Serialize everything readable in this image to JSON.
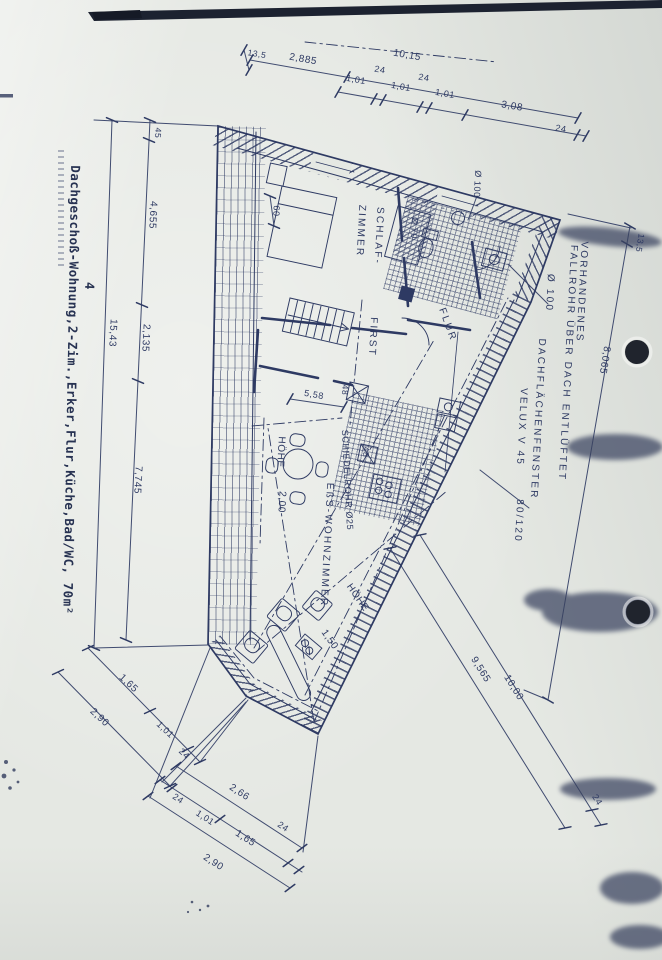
{
  "palette": {
    "ink": "#2e3a63",
    "paper": "#e5e8e3"
  },
  "margin": {
    "title": "Dachgeschoß-Wohnung,2-Zim.,Erker,Flur,Küche,Bad/WC, 70m²",
    "mark": "4"
  },
  "rooms": {
    "schlaf1": "SCHLAF-",
    "schlaf2": "ZIMMER",
    "flur": "FLUR",
    "first": "FIRST",
    "wohnzimmer": "EßS-WOHNZIMMER",
    "hoehe2_label": "HÖHE",
    "hoehe2_value": "2,00",
    "hoehe15_label": "HÖHE",
    "hoehe15_value": "1,50",
    "schiedelrohr": "SCHIEDELROHR Ø25"
  },
  "annotations": {
    "vorhandenes": "VORHANDENES",
    "fallrohr": "FALLROHR ÜBER DACH ENTLÜFTET",
    "fallrohr_dia": "Ø 100",
    "dachflaechenfenster": "DACHFLÄCHENFENSTER",
    "velux": "VELUX V 45",
    "fenster_size": "80/120",
    "dia70": "Ø 70",
    "dia100": "Ø 100",
    "bed60": "60",
    "k48a": "48",
    "k48b": "48",
    "dim558": "5,58"
  },
  "dims": {
    "top": [
      "13,5",
      "2,885",
      "10,15",
      "1,01",
      "24",
      "1,01",
      "24",
      "1,01",
      "3,08",
      "24"
    ],
    "left": [
      "45",
      "4,655",
      "2,135",
      "15,43",
      "7,745"
    ],
    "right": [
      "13,5",
      "8,065"
    ],
    "diag": [
      "9,565",
      "10,00",
      "24"
    ],
    "bottom_left": [
      "1,65",
      "1,01",
      "24",
      "2,90"
    ],
    "bottom_center": [
      "2,66",
      "24",
      "1,01",
      "1,65",
      "24",
      "2,90"
    ]
  }
}
